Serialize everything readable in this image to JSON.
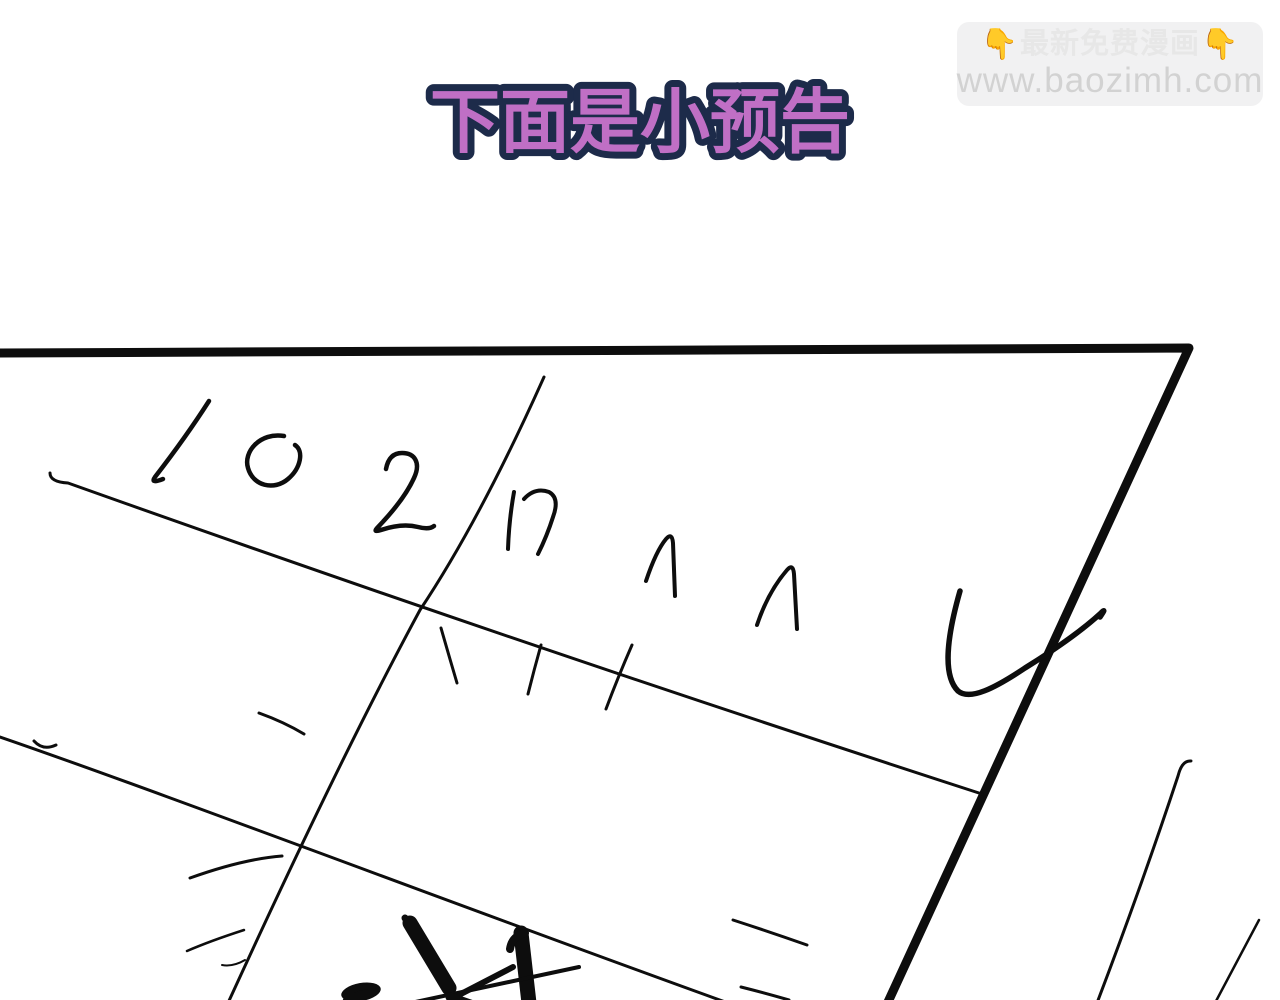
{
  "page": {
    "bg": "#ffffff"
  },
  "watermark": {
    "emoji_left": "👇",
    "line1": "最新免费漫画",
    "emoji_right": "👇",
    "line2": "www.baozimh.com",
    "colors": {
      "box_bg": "#f1f1f2",
      "line1": "#e7e7e7",
      "line2": "#d2d2d2",
      "emoji": "#f2bd3a"
    }
  },
  "title": {
    "text": "下面是小预告",
    "fill": "#c06fc5",
    "outline": "#1d2b4a"
  },
  "sketch": {
    "type": "hand-drawn rough preview panel, tilted",
    "handwritten_number": "102",
    "ink": "#0d0d0d",
    "elements": "tilted thick panel border, column line, two row lines, handwritten 102, tally scribbles, tick marks, large checkmark, crossed-out scribble, speed lines"
  }
}
